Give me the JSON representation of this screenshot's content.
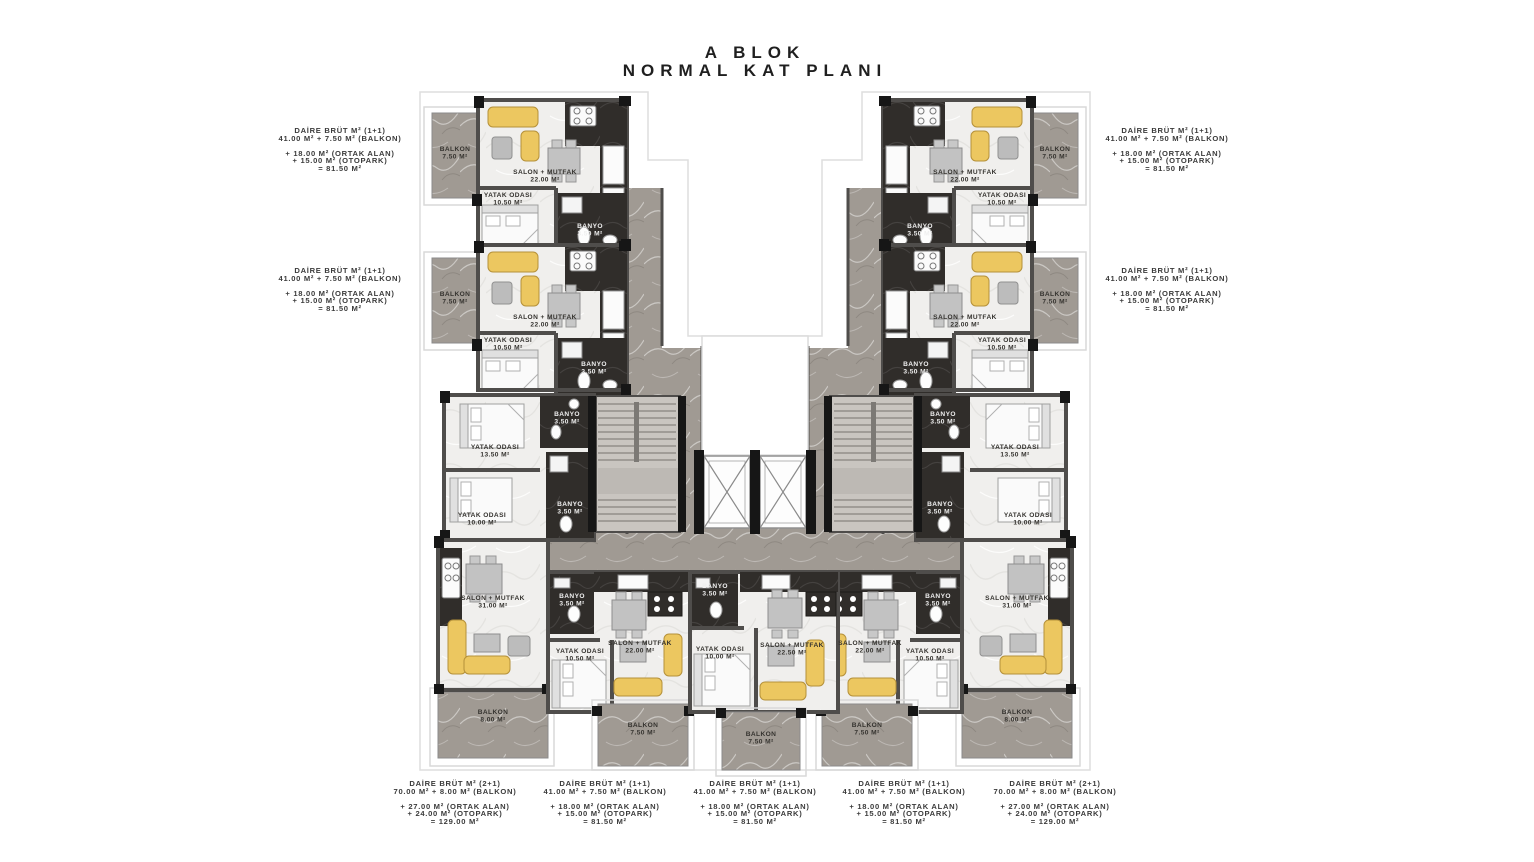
{
  "title": {
    "line1": "A BLOK",
    "line2": "NORMAL KAT PLANI"
  },
  "unit_summaries": {
    "left": [
      {
        "heading": "DAİRE BRÜT M² (1+1)",
        "gross": "41.00 M² + 7.50 M² (BALKON)",
        "ortak": "+ 18.00 M² (ORTAK ALAN)",
        "otopark": "+ 15.00 M² (OTOPARK)",
        "total": "= 81.50 M²"
      },
      {
        "heading": "DAİRE BRÜT M² (1+1)",
        "gross": "41.00 M² + 7.50 M² (BALKON)",
        "ortak": "+ 18.00 M² (ORTAK ALAN)",
        "otopark": "+ 15.00 M² (OTOPARK)",
        "total": "= 81.50 M²"
      }
    ],
    "right": [
      {
        "heading": "DAİRE BRÜT M² (1+1)",
        "gross": "41.00 M² + 7.50 M² (BALKON)",
        "ortak": "+ 18.00 M² (ORTAK ALAN)",
        "otopark": "+ 15.00 M² (OTOPARK)",
        "total": "= 81.50 M²"
      },
      {
        "heading": "DAİRE BRÜT M² (1+1)",
        "gross": "41.00 M² + 7.50 M² (BALKON)",
        "ortak": "+ 18.00 M² (ORTAK ALAN)",
        "otopark": "+ 15.00 M² (OTOPARK)",
        "total": "= 81.50 M²"
      }
    ],
    "bottom": [
      {
        "heading": "DAİRE BRÜT M² (2+1)",
        "gross": "70.00 M² + 8.00 M² (BALKON)",
        "ortak": "+ 27.00 M² (ORTAK ALAN)",
        "otopark": "+ 24.00 M² (OTOPARK)",
        "total": "= 129.00 M²"
      },
      {
        "heading": "DAİRE BRÜT M² (1+1)",
        "gross": "41.00 M² + 7.50 M² (BALKON)",
        "ortak": "+ 18.00 M² (ORTAK ALAN)",
        "otopark": "+ 15.00 M² (OTOPARK)",
        "total": "= 81.50 M²"
      },
      {
        "heading": "DAİRE BRÜT M² (1+1)",
        "gross": "41.00 M² + 7.50 M² (BALKON)",
        "ortak": "+ 18.00 M² (ORTAK ALAN)",
        "otopark": "+ 15.00 M² (OTOPARK)",
        "total": "= 81.50 M²"
      },
      {
        "heading": "DAİRE BRÜT M² (1+1)",
        "gross": "41.00 M² + 7.50 M² (BALKON)",
        "ortak": "+ 18.00 M² (ORTAK ALAN)",
        "otopark": "+ 15.00 M² (OTOPARK)",
        "total": "= 81.50 M²"
      },
      {
        "heading": "DAİRE BRÜT M² (2+1)",
        "gross": "70.00 M² + 8.00 M² (BALKON)",
        "ortak": "+ 27.00 M² (ORTAK ALAN)",
        "otopark": "+ 24.00 M² (OTOPARK)",
        "total": "= 129.00 M²"
      }
    ]
  },
  "floor_plan": {
    "colors": {
      "marble": "#a09a93",
      "floor": "#f0efed",
      "dark_zone": "#302d2a",
      "wall": "#4f4d4b",
      "furniture_yellow": "#ecc760",
      "stair_hall": "#c9c5c0"
    },
    "room_labels": [
      {
        "name": "BALKON",
        "area": "7.50 M²",
        "x": 455,
        "y": 151,
        "light": false
      },
      {
        "name": "SALON + MUTFAK",
        "area": "22.00 M²",
        "x": 545,
        "y": 174,
        "light": false
      },
      {
        "name": "YATAK ODASI",
        "area": "10.50 M²",
        "x": 508,
        "y": 197,
        "light": false
      },
      {
        "name": "BANYO",
        "area": "3.50 M²",
        "x": 590,
        "y": 228,
        "light": true
      },
      {
        "name": "BALKON",
        "area": "7.50 M²",
        "x": 455,
        "y": 296,
        "light": false
      },
      {
        "name": "SALON + MUTFAK",
        "area": "22.00 M²",
        "x": 545,
        "y": 319,
        "light": false
      },
      {
        "name": "YATAK ODASI",
        "area": "10.50 M²",
        "x": 508,
        "y": 342,
        "light": false
      },
      {
        "name": "BANYO",
        "area": "3.50 M²",
        "x": 594,
        "y": 366,
        "light": true
      },
      {
        "name": "BALKON",
        "area": "7.50 M²",
        "x": 1055,
        "y": 151,
        "light": false
      },
      {
        "name": "SALON + MUTFAK",
        "area": "22.00 M²",
        "x": 965,
        "y": 174,
        "light": false
      },
      {
        "name": "YATAK ODASI",
        "area": "10.50 M²",
        "x": 1002,
        "y": 197,
        "light": false
      },
      {
        "name": "BANYO",
        "area": "3.50 M²",
        "x": 920,
        "y": 228,
        "light": true
      },
      {
        "name": "BALKON",
        "area": "7.50 M²",
        "x": 1055,
        "y": 296,
        "light": false
      },
      {
        "name": "SALON + MUTFAK",
        "area": "22.00 M²",
        "x": 965,
        "y": 319,
        "light": false
      },
      {
        "name": "YATAK ODASI",
        "area": "10.50 M²",
        "x": 1002,
        "y": 342,
        "light": false
      },
      {
        "name": "BANYO",
        "area": "3.50 M²",
        "x": 916,
        "y": 366,
        "light": true
      },
      {
        "name": "YATAK ODASI",
        "area": "13.50 M²",
        "x": 495,
        "y": 449,
        "light": false
      },
      {
        "name": "YATAK ODASI",
        "area": "10.00 M²",
        "x": 482,
        "y": 517,
        "light": false
      },
      {
        "name": "BANYO",
        "area": "3.50 M²",
        "x": 567,
        "y": 416,
        "light": true
      },
      {
        "name": "BANYO",
        "area": "3.50 M²",
        "x": 570,
        "y": 506,
        "light": true
      },
      {
        "name": "YATAK ODASI",
        "area": "13.50 M²",
        "x": 1015,
        "y": 449,
        "light": false
      },
      {
        "name": "YATAK ODASI",
        "area": "10.00 M²",
        "x": 1028,
        "y": 517,
        "light": false
      },
      {
        "name": "BANYO",
        "area": "3.50 M²",
        "x": 943,
        "y": 416,
        "light": true
      },
      {
        "name": "BANYO",
        "area": "3.50 M²",
        "x": 940,
        "y": 506,
        "light": true
      },
      {
        "name": "SALON + MUTFAK",
        "area": "31.00 M²",
        "x": 493,
        "y": 600,
        "light": false
      },
      {
        "name": "BANYO",
        "area": "3.50 M²",
        "x": 572,
        "y": 598,
        "light": true
      },
      {
        "name": "YATAK ODASI",
        "area": "10.50 M²",
        "x": 580,
        "y": 653,
        "light": false
      },
      {
        "name": "SALON + MUTFAK",
        "area": "22.00 M²",
        "x": 640,
        "y": 645,
        "light": false
      },
      {
        "name": "BALKON",
        "area": "8.00 M²",
        "x": 493,
        "y": 714,
        "light": false
      },
      {
        "name": "BALKON",
        "area": "7.50 M²",
        "x": 643,
        "y": 727,
        "light": false
      },
      {
        "name": "BANYO",
        "area": "3.50 M²",
        "x": 715,
        "y": 588,
        "light": true
      },
      {
        "name": "YATAK ODASI",
        "area": "10.00 M²",
        "x": 720,
        "y": 651,
        "light": false
      },
      {
        "name": "SALON + MUTFAK",
        "area": "22.50 M²",
        "x": 792,
        "y": 647,
        "light": false
      },
      {
        "name": "BALKON",
        "area": "7.50 M²",
        "x": 761,
        "y": 736,
        "light": false
      },
      {
        "name": "SALON + MUTFAK",
        "area": "22.00 M²",
        "x": 870,
        "y": 645,
        "light": false
      },
      {
        "name": "YATAK ODASI",
        "area": "10.50 M²",
        "x": 930,
        "y": 653,
        "light": false
      },
      {
        "name": "BANYO",
        "area": "3.50 M²",
        "x": 938,
        "y": 598,
        "light": true
      },
      {
        "name": "SALON + MUTFAK",
        "area": "31.00 M²",
        "x": 1017,
        "y": 600,
        "light": false
      },
      {
        "name": "BALKON",
        "area": "8.00 M²",
        "x": 1017,
        "y": 714,
        "light": false
      },
      {
        "name": "BALKON",
        "area": "7.50 M²",
        "x": 867,
        "y": 727,
        "light": false
      }
    ]
  }
}
